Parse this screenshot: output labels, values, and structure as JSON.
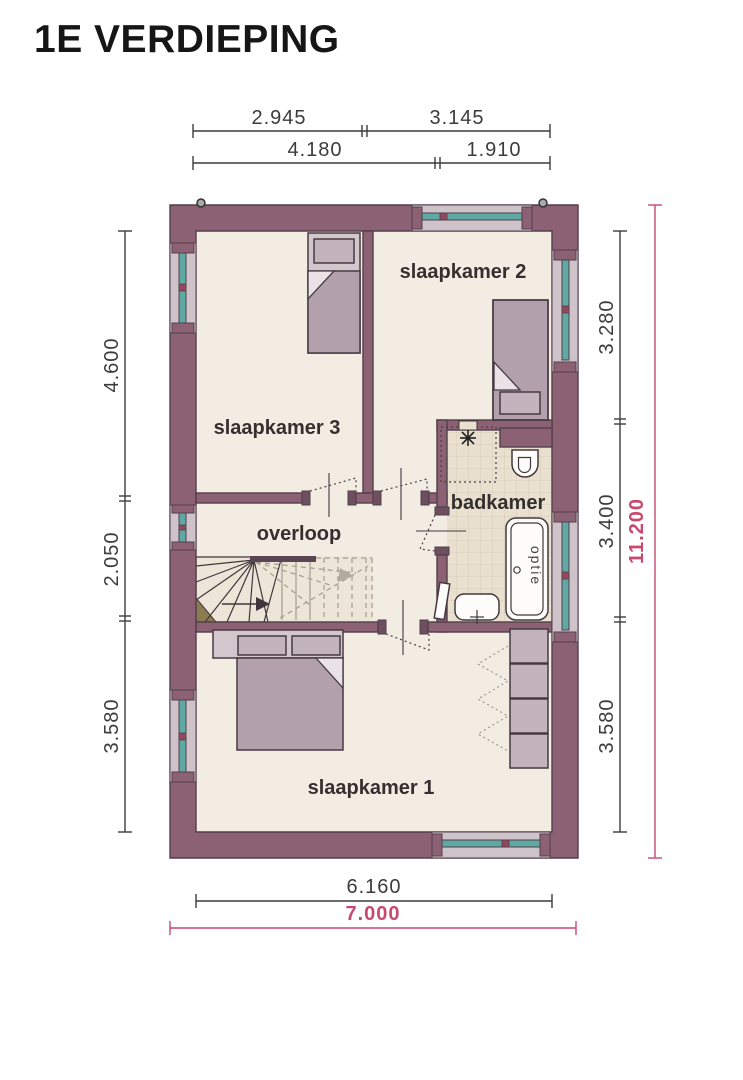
{
  "title": "1E VERDIEPING",
  "rooms": [
    {
      "id": "slaapkamer-2",
      "label": "slaapkamer 2"
    },
    {
      "id": "slaapkamer-3",
      "label": "slaapkamer 3"
    },
    {
      "id": "overloop",
      "label": "overloop"
    },
    {
      "id": "badkamer",
      "label": "badkamer"
    },
    {
      "id": "slaapkamer-1",
      "label": "slaapkamer 1"
    }
  ],
  "fixtures": {
    "bathtub_label": "optie"
  },
  "dimensions": {
    "top_row1": [
      "2.945",
      "3.145"
    ],
    "top_row2": [
      "4.180",
      "1.910"
    ],
    "left": [
      "4.600",
      "2.050",
      "3.580"
    ],
    "right": [
      "3.280",
      "3.400",
      "3.580"
    ],
    "right_total": "11.200",
    "bottom_inner": "6.160",
    "bottom_total": "7.000"
  },
  "icons": {
    "vent": "extract-vent-asterisk",
    "downpipe": "rainwater-downpipe",
    "stairs_arrow": "stairs-up-arrow"
  },
  "colors": {
    "wall": "#8c6173",
    "wallline": "#533f4b",
    "floor": "#f2ece2",
    "tile": "#eae0d0",
    "tilegrid": "#d8ccb8",
    "glass": "#5ea9a3",
    "frame": "#cdc3c9",
    "mullion": "#91485d",
    "furn": "#c3b3bd",
    "furndark": "#b2a1ad",
    "furnlight": "#d3c7cd",
    "accent": "#c8496f",
    "label": "#35302f",
    "dim": "#3c3c3c",
    "tread": "#a59c8f"
  }
}
